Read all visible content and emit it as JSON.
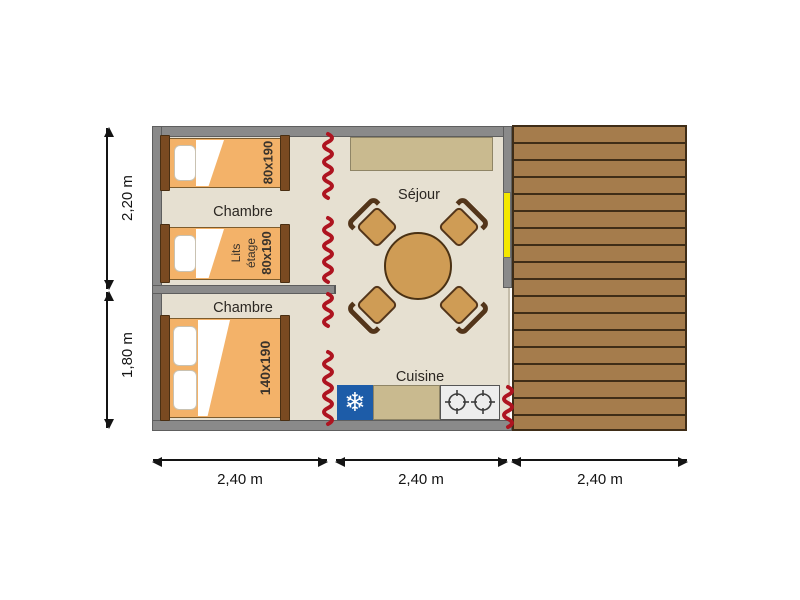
{
  "rooms": {
    "bedroom_top": "Chambre",
    "bedroom_bottom": "Chambre",
    "living": "Séjour",
    "kitchen": "Cuisine"
  },
  "beds": {
    "single_top": {
      "size": "80x190"
    },
    "bunk": {
      "label": [
        "Lits",
        "étage"
      ],
      "size": "80x190"
    },
    "double": {
      "size": "140x190"
    }
  },
  "dimensions": {
    "vertical": [
      {
        "label": "2,20 m"
      },
      {
        "label": "1,80 m"
      }
    ],
    "horizontal": [
      {
        "label": "2,40 m"
      },
      {
        "label": "2,40 m"
      },
      {
        "label": "2,40 m"
      }
    ]
  },
  "icons": {
    "fridge_snowflake": "❄"
  },
  "colors": {
    "wall_gray": "#8a8a8a",
    "wall_edge": "#5e5e5e",
    "floor_beige": "#e6e0d1",
    "bed_orange": "#f3b269",
    "wood_brown": "#7a4a21",
    "wood_dark": "#53351a",
    "deck_plank": "#a57c4c",
    "deck_line": "#3f2d17",
    "canvas_red": "#ae1420",
    "door_yellow": "#f4e800",
    "fridge_blue": "#1d5ca8",
    "bench_tan": "#c9ba8f",
    "table_tan": "#cf9c55",
    "stove_gray": "#ededed",
    "text_dark": "#2b2722"
  }
}
